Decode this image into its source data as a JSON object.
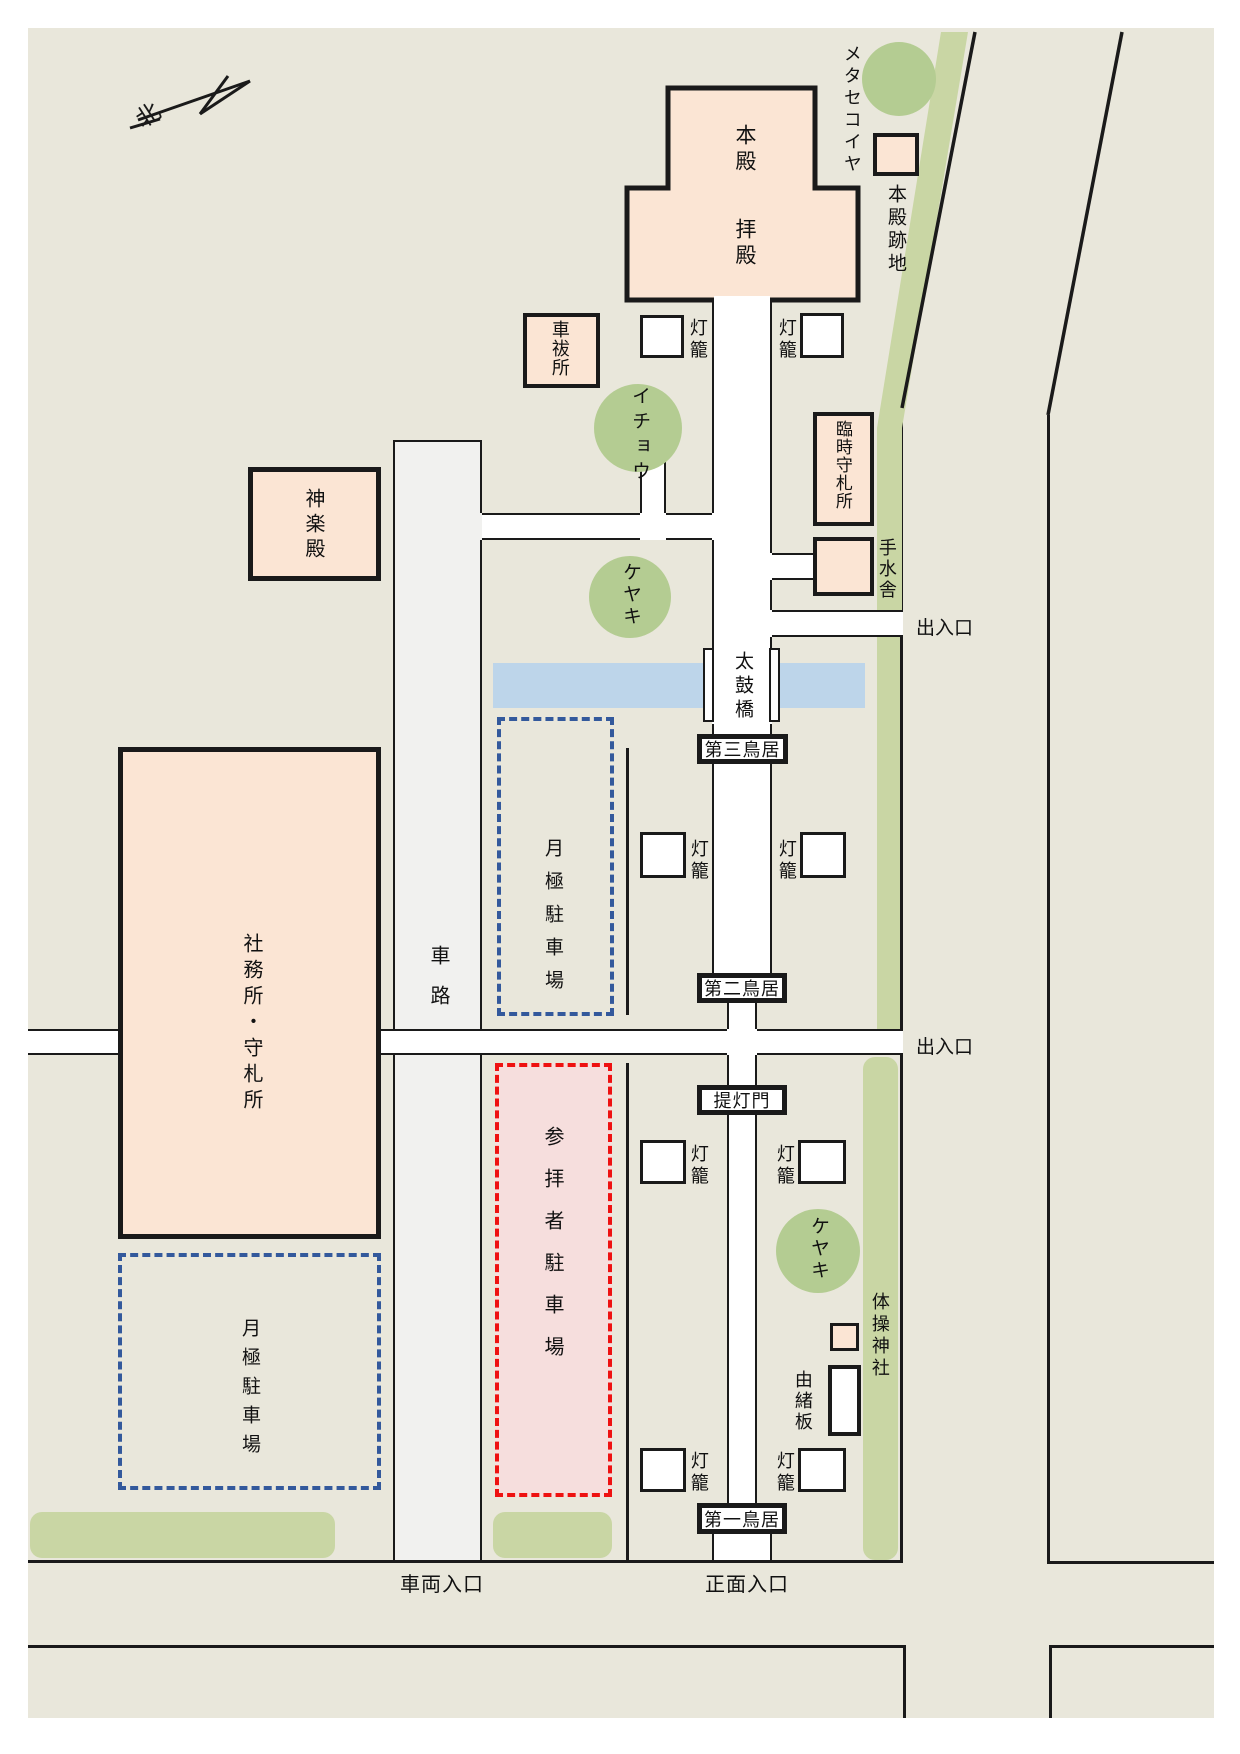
{
  "compass": {
    "north_char": "北"
  },
  "buildings": {
    "honden": "本殿",
    "haiden": "拝殿",
    "honden_site": "本殿跡地",
    "car_purification": "車祓所",
    "kagura_hall": "神楽殿",
    "temp_amulet_office": "臨時守札所",
    "temizuya": "手水舎",
    "office": "社務所・守札所",
    "taiso_shrine": "体操神社",
    "history_board": "由緒板"
  },
  "gates": {
    "third": "第三鳥居",
    "second": "第二鳥居",
    "lantern_gate": "提灯門",
    "first": "第一鳥居"
  },
  "lantern": "灯籠",
  "trees": {
    "metasequoia": "メタセコイヤ",
    "ginkgo": "イチョウ",
    "zelkova": "ケヤキ"
  },
  "parking": {
    "monthly": "月極駐車場",
    "visitor": "参拝者駐車場"
  },
  "roads": {
    "drive": "車路",
    "bridge": "太鼓橋",
    "gate_exit": "出入口",
    "vehicle_entrance": "車両入口",
    "main_entrance": "正面入口"
  },
  "colors": {
    "background": "#e9e7db",
    "building_fill": "#fbe5d4",
    "green_strip": "#c9d6a4",
    "tree": "#b4cc92",
    "water": "#bdd5ea",
    "monthly_dash": "#33599c",
    "visitor_dash": "#ee1111",
    "visitor_fill": "#f6dedd",
    "drive_lane": "#f1f1ef",
    "line": "#1a1a1a"
  }
}
